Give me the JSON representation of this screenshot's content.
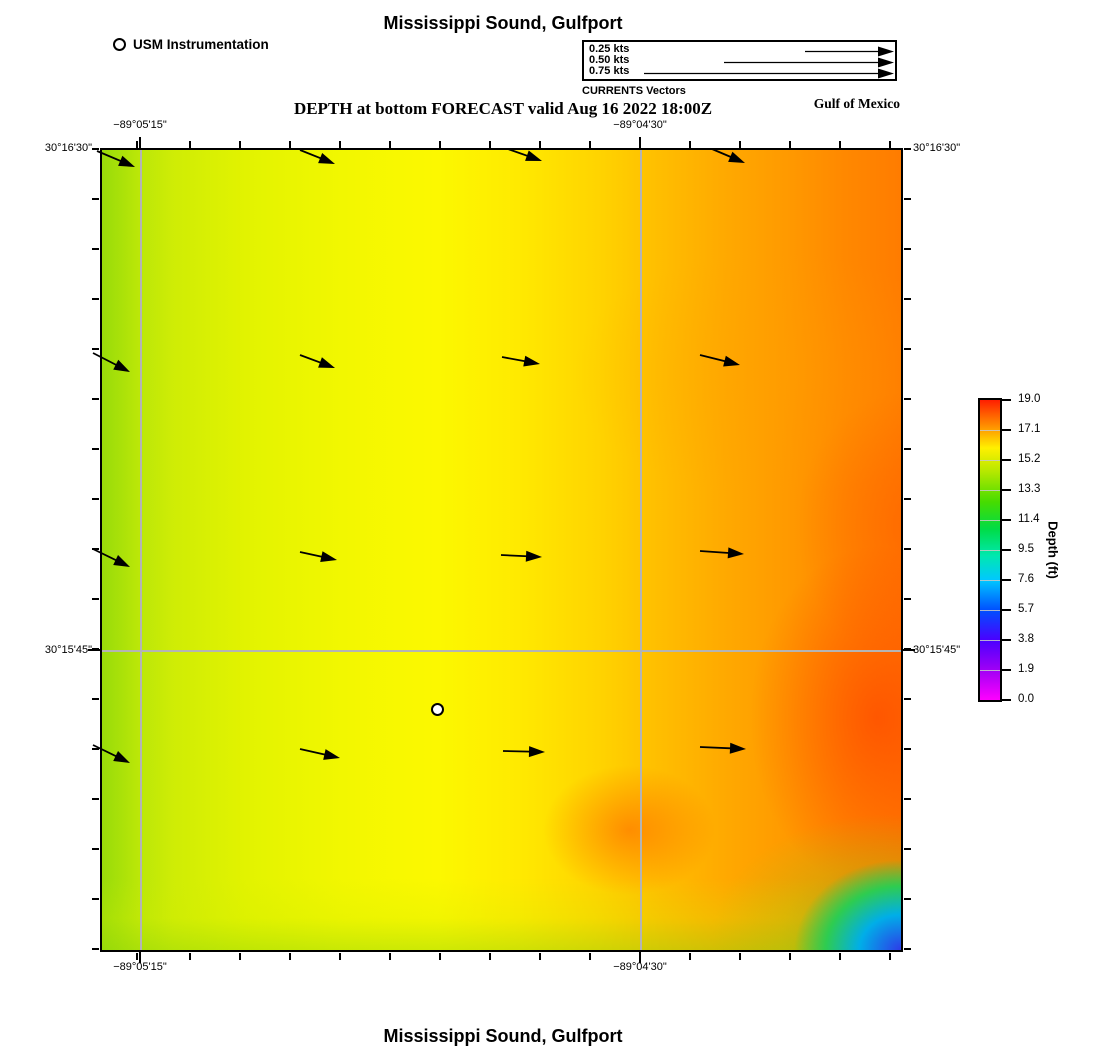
{
  "header": {
    "title": "Mississippi Sound, Gulfport",
    "instrument_legend_label": "USM Instrumentation",
    "vector_legend": {
      "caption": "CURRENTS Vectors",
      "tip_x": 310,
      "entries": [
        {
          "label": "0.25 kts",
          "tail_x": 221,
          "y": 9.5
        },
        {
          "label": "0.50 kts",
          "tail_x": 140,
          "y": 20.5
        },
        {
          "label": "0.75 kts",
          "tail_x": 60,
          "y": 31.5
        }
      ]
    },
    "subtitle": "DEPTH at bottom FORECAST valid Aug 16 2022 18:00Z",
    "region_label": "Gulf of Mexico"
  },
  "axes": {
    "x_labels": [
      {
        "text": "−89°05'15\""
      },
      {
        "text": "−89°04'30\""
      }
    ],
    "y_labels": [
      {
        "text": "30°16'30\""
      },
      {
        "text": "30°15'45\""
      }
    ]
  },
  "colorbar": {
    "label": "Depth (ft)",
    "ticks": [
      "19.0",
      "17.1",
      "15.2",
      "13.3",
      "11.4",
      "9.5",
      "7.6",
      "5.7",
      "3.8",
      "1.9",
      "0.0"
    ]
  },
  "map": {
    "marker_name": "USM Instrumentation station",
    "arrows": [
      [
        97,
        151,
        135,
        167
      ],
      [
        300,
        150,
        335,
        164
      ],
      [
        508,
        149,
        542,
        161
      ],
      [
        712,
        149,
        745,
        163
      ],
      [
        93,
        353,
        130,
        372
      ],
      [
        300,
        355,
        335,
        368
      ],
      [
        502,
        357,
        540,
        364
      ],
      [
        700,
        355,
        740,
        365
      ],
      [
        93,
        549,
        130,
        567
      ],
      [
        300,
        552,
        337,
        560
      ],
      [
        501,
        555,
        542,
        557
      ],
      [
        700,
        551,
        744,
        554
      ],
      [
        93,
        745,
        130,
        763
      ],
      [
        300,
        749,
        340,
        758
      ],
      [
        503,
        751,
        545,
        752
      ],
      [
        700,
        747,
        746,
        749
      ]
    ]
  },
  "footer": {
    "title": "Mississippi Sound, Gulfport"
  },
  "chart_data": {
    "type": "heatmap",
    "title": "Mississippi Sound, Gulfport — DEPTH at bottom FORECAST valid Aug 16 2022 18:00Z",
    "colorbar_label": "Depth (ft)",
    "colorbar_ticks": [
      19.0,
      17.1,
      15.2,
      13.3,
      11.4,
      9.5,
      7.6,
      5.7,
      3.8,
      1.9,
      0.0
    ],
    "depth_range_ft": [
      0.0,
      19.0
    ],
    "lon_gridlines": [
      "−89°05'15\"",
      "−89°04'30\""
    ],
    "lat_gridlines": [
      "30°16'30\"",
      "30°15'45\""
    ],
    "field_description": "Depth ~13-15 ft (green-yellow) on the west side increasing to ~17-19 ft (orange-red) toward the east; shallow 0-8 ft (green/cyan/blue) pocket in the far southeast corner",
    "current_vectors": "4x4 grid of small black arrows pointing east (~0.1 kt), tilting southeastward along the west edge",
    "legend_scale_kts": [
      0.25,
      0.5,
      0.75
    ],
    "station_marker": "white circle with black ring near map center-south"
  }
}
